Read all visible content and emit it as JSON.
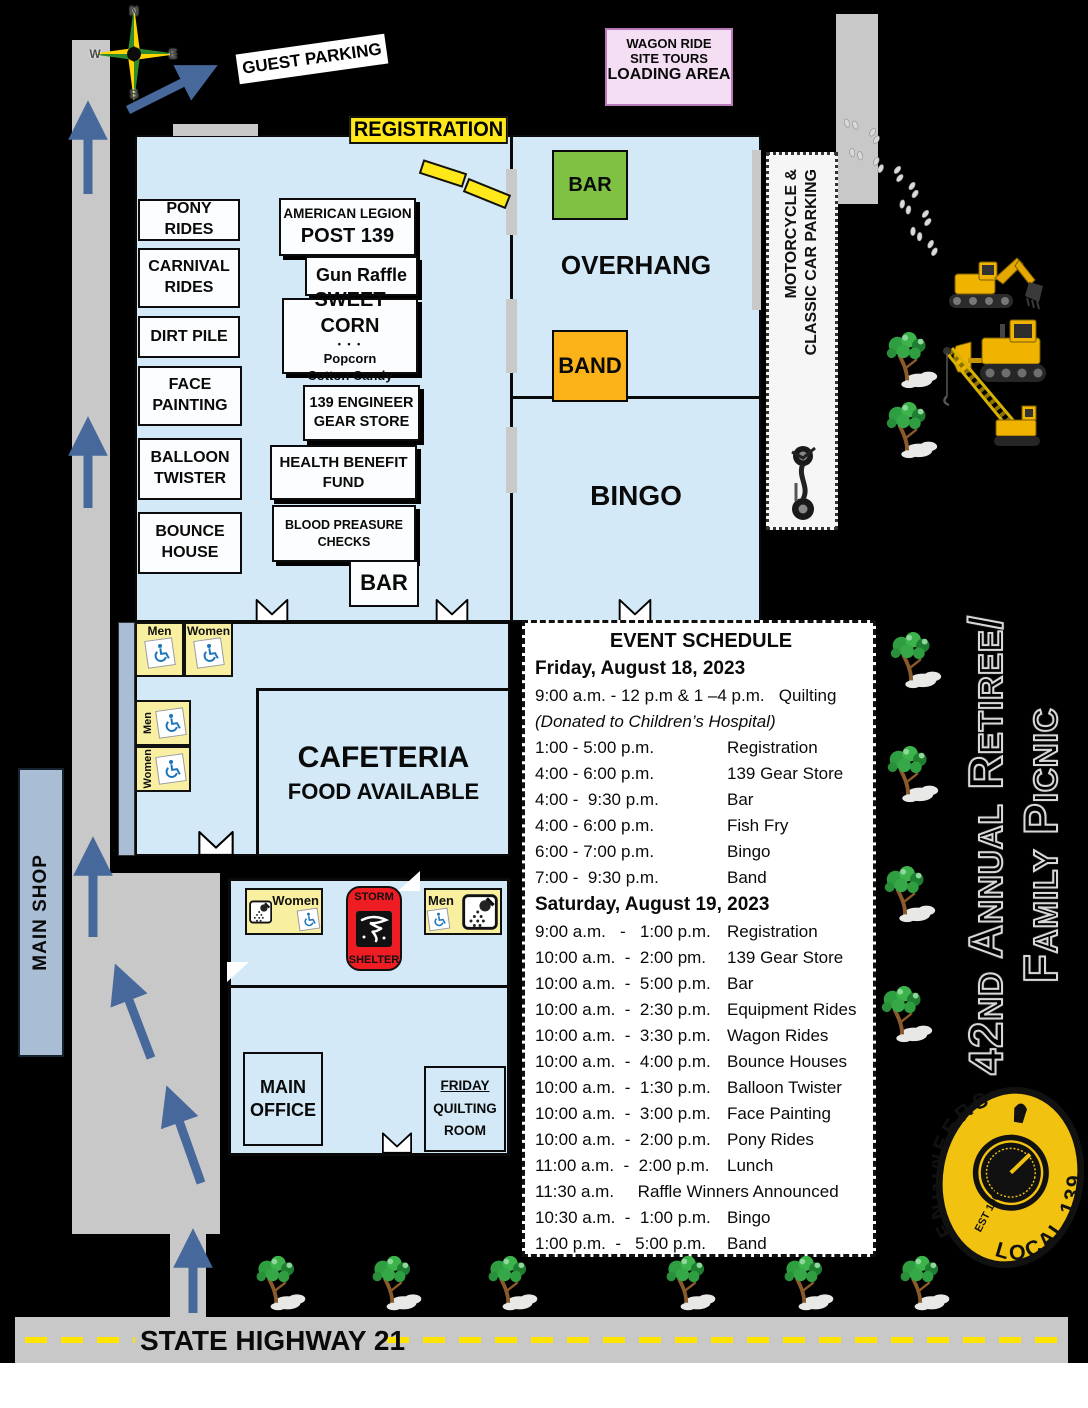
{
  "colors": {
    "background": "#000000",
    "building_fill": "#d3e9f8",
    "road_gray": "#c8c8c8",
    "registration_yellow": "#ffe81a",
    "bar_green": "#7ec143",
    "band_orange": "#fcb31a",
    "storm_red": "#ee1c23",
    "restroom_yellow": "#f8efa0",
    "wagon_pink": "#f4def4",
    "arrow_blue": "#46689b",
    "wheelchair_blue": "#1b75bb",
    "shop_blue_gray": "#a9bdd4",
    "logo_yellow": "#f2c211",
    "dash_yellow": "#ffe400"
  },
  "compass": {
    "n": "N",
    "e": "E",
    "s": "S",
    "w": "W"
  },
  "top": {
    "guest_parking": "GUEST PARKING",
    "registration": "REGISTRATION",
    "wagon_l1": "WAGON RIDE",
    "wagon_l2": "SITE TOURS",
    "wagon_l3": "LOADING AREA"
  },
  "activities": {
    "pony": "PONY RIDES",
    "carnival_l1": "CARNIVAL",
    "carnival_l2": "RIDES",
    "dirt": "DIRT PILE",
    "face_l1": "FACE",
    "face_l2": "PAINTING",
    "balloon_l1": "BALLOON",
    "balloon_l2": "TWISTER",
    "bounce_l1": "BOUNCE",
    "bounce_l2": "HOUSE"
  },
  "vendors": {
    "legion_l1": "AMERICAN LEGION",
    "legion_l2": "POST 139",
    "gun_raffle": "Gun Raffle",
    "sweet_l1": "SWEET CORN",
    "sweet_dots": "• • •",
    "sweet_l2": "Popcorn",
    "sweet_l3": "Cotton Candy",
    "gear_l1": "139 ENGINEER",
    "gear_l2": "GEAR STORE",
    "health_l1": "HEALTH BENEFIT",
    "health_l2": "FUND",
    "blood_l1": "BLOOD PREASURE",
    "blood_l2": "CHECKS",
    "bar": "BAR"
  },
  "hall": {
    "bar": "BAR",
    "overhang": "OVERHANG",
    "band": "BAND",
    "bingo": "BINGO"
  },
  "parking": {
    "moto_l1": "MOTORCYCLE &",
    "moto_l2": "CLASSIC CAR PARKING"
  },
  "cafeteria": {
    "l1": "CAFETERIA",
    "l2": "FOOD AVAILABLE"
  },
  "restrooms": {
    "men": "Men",
    "women": "Women"
  },
  "shelter": {
    "l1": "STORM",
    "l2": "SHELTER"
  },
  "rooms": {
    "office_l1": "MAIN",
    "office_l2": "OFFICE",
    "quilting_l1": "FRIDAY",
    "quilting_l2": "QUILTING",
    "quilting_l3": "ROOM"
  },
  "main_shop": "MAIN SHOP",
  "highway": "STATE HIGHWAY 21",
  "banner": {
    "l1": "42nd Annual Retiree/",
    "l2": "Family Picnic"
  },
  "logo": {
    "arc_left": "ENGINEERS",
    "arc_right": "LOCAL 139",
    "est": "EST 1902"
  },
  "schedule": {
    "title": "EVENT SCHEDULE",
    "friday_heading": "Friday, August 18, 2023",
    "friday_quilting": "9:00 a.m. - 12 p.m & 1 –4 p.m.   Quilting",
    "friday_note": "(Donated to Children’s Hospital)",
    "friday_rows": [
      {
        "time": "1:00 - 5:00 p.m.",
        "event": "Registration"
      },
      {
        "time": "4:00 - 6:00 p.m.",
        "event": "139 Gear Store"
      },
      {
        "time": "4:00 -  9:30 p.m.",
        "event": "Bar"
      },
      {
        "time": "4:00 - 6:00 p.m.",
        "event": "Fish Fry"
      },
      {
        "time": "6:00 - 7:00 p.m.",
        "event": "Bingo"
      },
      {
        "time": "7:00 -  9:30 p.m.",
        "event": "Band"
      }
    ],
    "saturday_heading": "Saturday, August 19, 2023",
    "saturday_rows": [
      {
        "time": "9:00 a.m.   -   1:00 p.m.",
        "event": "Registration"
      },
      {
        "time": "10:00 a.m.  -  2:00 pm.",
        "event": "139 Gear Store"
      },
      {
        "time": "10:00 a.m.  -  5:00 p.m.",
        "event": "Bar"
      },
      {
        "time": "10:00 a.m.  -  2:30 p.m.",
        "event": "Equipment Rides"
      },
      {
        "time": "10:00 a.m.  -  3:30 p.m.",
        "event": "Wagon Rides"
      },
      {
        "time": "10:00 a.m.  -  4:00 p.m.",
        "event": "Bounce Houses"
      },
      {
        "time": "10:00 a.m.  -  1:30 p.m.",
        "event": "Balloon Twister"
      },
      {
        "time": "10:00 a.m.  -  3:00 p.m.",
        "event": "Face Painting"
      },
      {
        "time": "10:00 a.m.  -  2:00 p.m.",
        "event": "Pony Rides"
      },
      {
        "time": "11:00 a.m.  -  2:00 p.m.",
        "event": "Lunch"
      }
    ],
    "raffle_line": "11:30 a.m.     Raffle Winners Announced",
    "saturday_rows2": [
      {
        "time": "10:30 a.m.  -  1:00 p.m.",
        "event": "Bingo"
      },
      {
        "time": "1:00 p.m.  -   5:00 p.m.",
        "event": "Band"
      }
    ]
  },
  "icons": {
    "compass_rose": "compass-rose-icon",
    "flow_arrow": "flow-arrow-icon",
    "footprints": "footprints-icon",
    "excavator": "excavator-icon",
    "bulldozer": "bulldozer-icon",
    "crane": "crane-icon",
    "motorcycle": "motorcycle-icon",
    "tree": "tree-icon",
    "wheelchair": "wheelchair-icon",
    "shower": "shower-icon",
    "tornado": "tornado-icon",
    "door": "door-swing-icon",
    "picnic_table": "picnic-table-icon"
  }
}
